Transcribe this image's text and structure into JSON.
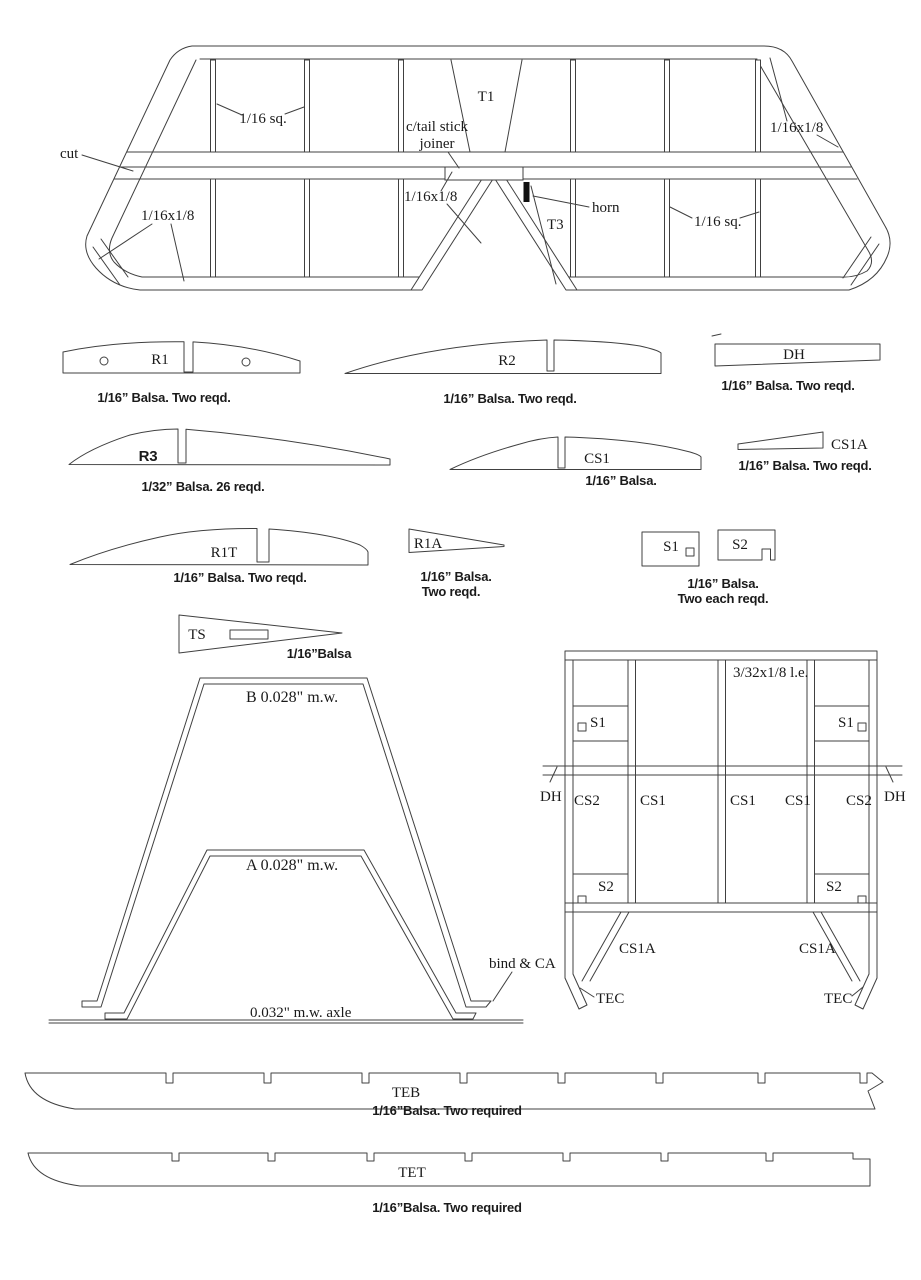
{
  "colors": {
    "line": "#404040",
    "text": "#1a1a1a",
    "background": "#ffffff",
    "horn_fill": "#111111"
  },
  "tailplane": {
    "cut": "cut",
    "top_left_size": "1/16 sq.",
    "t1": "T1",
    "joiner_line1": "c/tail stick",
    "joiner_line2": "joiner",
    "top_right_size": "1/16x1/8",
    "mid_size": "1/16x1/8",
    "horn": "horn",
    "t3": "T3",
    "bottom_right_size": "1/16 sq.",
    "bottom_left_size": "1/16x1/8"
  },
  "r1": {
    "label": "R1",
    "caption": "1/16” Balsa. Two reqd."
  },
  "r2": {
    "label": "R2",
    "caption": "1/16” Balsa. Two reqd."
  },
  "dh": {
    "label": "DH",
    "caption": "1/16” Balsa. Two reqd."
  },
  "r3": {
    "label": "R3",
    "caption": "1/32” Balsa. 26 reqd."
  },
  "cs1": {
    "label": "CS1",
    "caption": "1/16” Balsa."
  },
  "cs1a": {
    "label": "CS1A",
    "caption": "1/16” Balsa. Two reqd."
  },
  "r1t": {
    "label": "R1T",
    "caption": "1/16” Balsa. Two reqd."
  },
  "r1a": {
    "label": "R1A",
    "caption_line1": "1/16” Balsa.",
    "caption_line2": "Two reqd."
  },
  "s_parts": {
    "s1": "S1",
    "s2": "S2",
    "caption_line1": "1/16” Balsa.",
    "caption_line2": "Two each reqd."
  },
  "ts": {
    "label": "TS",
    "caption": "1/16”Balsa"
  },
  "landing_gear": {
    "b_label": "B 0.028\" m.w.",
    "a_label": "A 0.028\" m.w.",
    "bind_label": "bind & CA",
    "axle_label": "0.032\" m.w. axle"
  },
  "center_section": {
    "le_size": "3/32x1/8 l.e.",
    "s1_left": "S1",
    "s1_right": "S1",
    "dh_left": "DH",
    "dh_right": "DH",
    "cs2_left": "CS2",
    "cs1_a": "CS1",
    "cs1_b": "CS1",
    "cs1_c": "CS1",
    "cs2_right": "CS2",
    "s2_left": "S2",
    "s2_right": "S2",
    "cs1a_left": "CS1A",
    "cs1a_right": "CS1A",
    "tec_left": "TEC",
    "tec_right": "TEC"
  },
  "teb": {
    "label": "TEB",
    "caption": "1/16”Balsa. Two required"
  },
  "tet": {
    "label": "TET",
    "caption": "1/16”Balsa. Two required"
  }
}
